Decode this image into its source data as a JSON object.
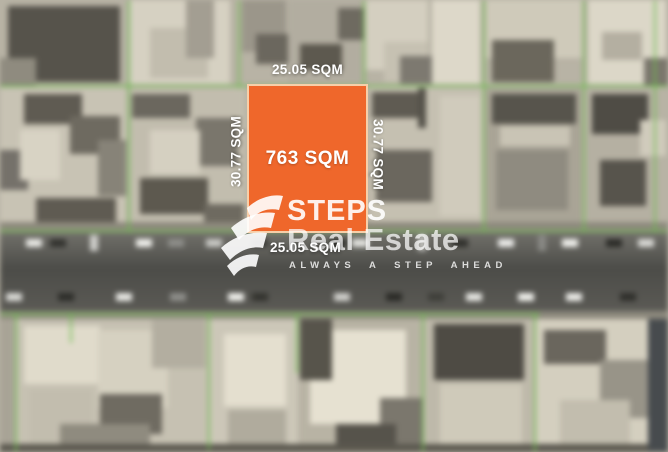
{
  "plot": {
    "area_label": "763 SQM",
    "width_label_top": "25.05 SQM",
    "width_label_bottom": "25.05 SQM",
    "depth_label_left": "30.77 SQM",
    "depth_label_right": "30.77 SQM"
  },
  "watermark": {
    "brand_line1": "STEPS",
    "brand_line2": "Real Estate",
    "tagline": "ALWAYS A STEP AHEAD",
    "logo_icon": "steps-stacked-ribbons-icon"
  },
  "colors": {
    "plot_fill": "#EF672B",
    "plot_border": "#F6CFA9",
    "boundary_green": "#6CBE4B",
    "road_gray": "#55544F",
    "watermark_white": "#FFFFFF"
  }
}
